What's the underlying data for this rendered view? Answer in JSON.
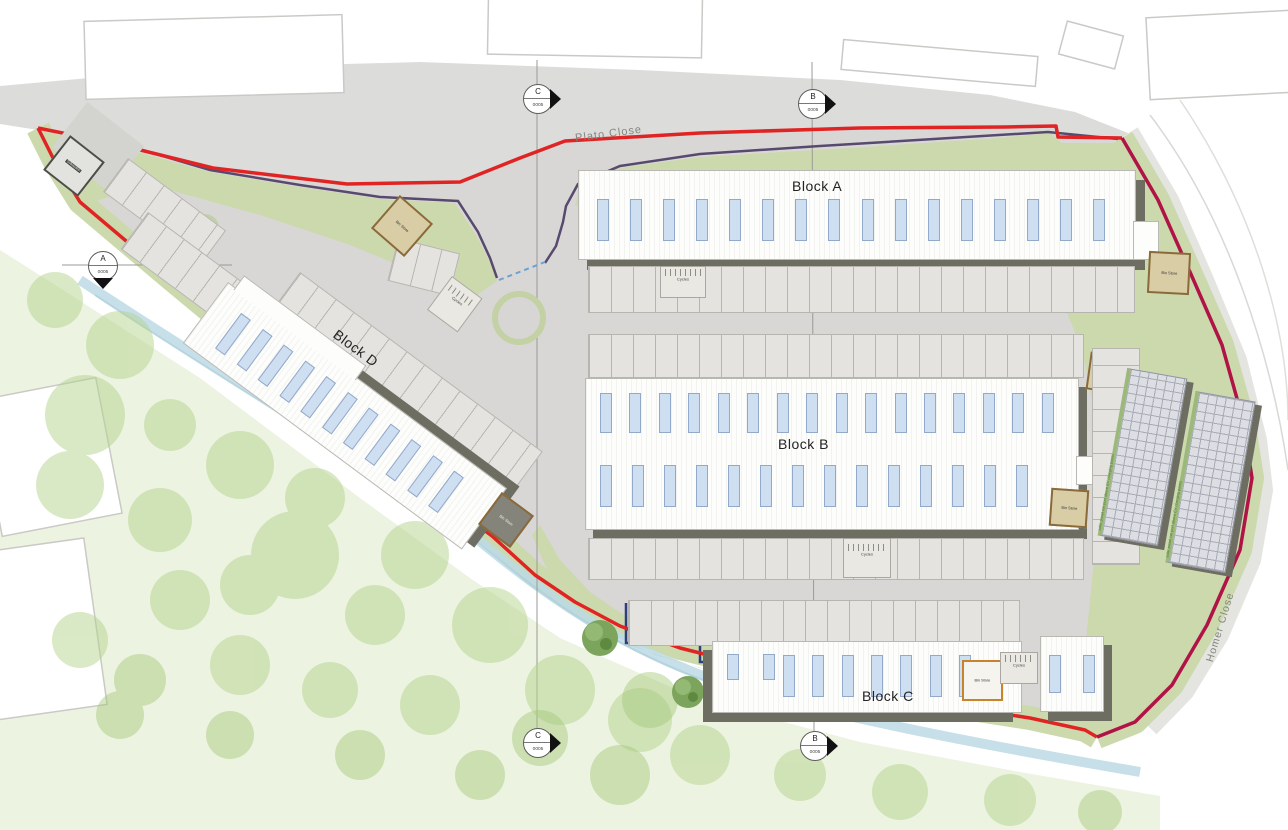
{
  "drawing": {
    "type": "architectural site plan",
    "streets": {
      "top": "Plato Close",
      "right": "Homer Close"
    },
    "blocks": {
      "a": {
        "label": "Block A"
      },
      "b": {
        "label": "Block B"
      },
      "c": {
        "label": "Block C"
      },
      "d": {
        "label": "Block D"
      }
    },
    "facilities": {
      "bin_store": "Bin Store",
      "cycles": "Cycles",
      "substation": "Substation",
      "carport_note": "solar panel car port above EV charging points"
    },
    "section_markers": [
      {
        "letter": "C",
        "ref": "0005"
      },
      {
        "letter": "B",
        "ref": "0005"
      },
      {
        "letter": "A",
        "ref": "0005"
      },
      {
        "letter": "C",
        "ref": "0005"
      },
      {
        "letter": "B",
        "ref": "0005"
      }
    ],
    "colors": {
      "site_boundary_red": "#e02424",
      "right_boundary_crimson": "#b01345",
      "demise_line_purple": "#584a6e",
      "connection_dashed_blue": "#6aa2d8",
      "plot_line_navy": "#2f3f7e",
      "landscape_green": "#ccd9ad",
      "hardstanding_gray": "#d8d7d5",
      "building_shadow": "#6d6d62",
      "window_blue": "#cfdff2",
      "bin_store_brown": "#8a6a3a",
      "bin_store_orange": "#c8842c",
      "stream_blue": "#bcd9e4"
    }
  }
}
